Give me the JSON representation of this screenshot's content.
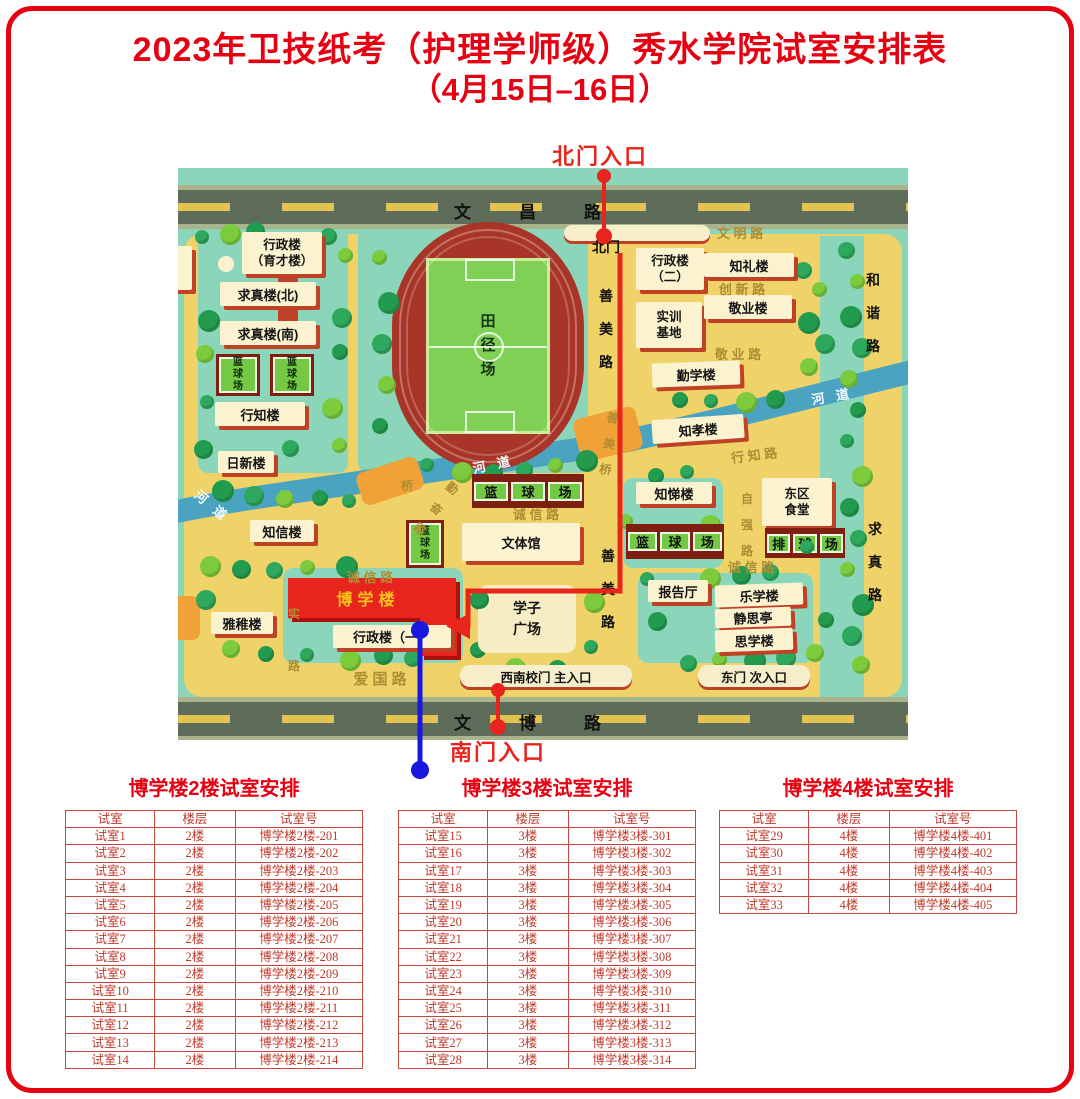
{
  "page": {
    "title_line1": "2023年卫技纸考（护理学师级）秀水学院试室安排表",
    "title_line2": "（4月15日–16日）"
  },
  "map": {
    "north_gate_entrance": "北门入口",
    "south_gate_entrance": "南门入口",
    "top_road": "文昌路",
    "bottom_road": "文博路",
    "track_label": "田\n径\n场",
    "items": [
      {
        "id": "bld-xingzhenglou-yucai",
        "cls": "b2",
        "label": "行政楼\n（育才楼）",
        "x": 64,
        "y": 64,
        "w": 80,
        "h": 42
      },
      {
        "id": "bld-qiuzhenlou-north",
        "cls": "b",
        "label": "求真楼(北)",
        "x": 42,
        "y": 114,
        "w": 96,
        "h": 24
      },
      {
        "id": "bld-qiuzhenlou-south",
        "cls": "b",
        "label": "求真楼(南)",
        "x": 42,
        "y": 153,
        "w": 96,
        "h": 24
      },
      {
        "id": "court-left-1",
        "cls": "courtv",
        "label": "篮\n球\n场",
        "x": 38,
        "y": 186,
        "w": 44,
        "h": 42
      },
      {
        "id": "court-left-2",
        "cls": "courtv",
        "label": "篮\n球\n场",
        "x": 92,
        "y": 186,
        "w": 44,
        "h": 42
      },
      {
        "id": "bld-xingzhilou",
        "cls": "b",
        "label": "行知楼",
        "x": 37,
        "y": 234,
        "w": 90,
        "h": 24
      },
      {
        "id": "bld-rixinlou",
        "cls": "b",
        "label": "日新楼",
        "x": 40,
        "y": 283,
        "w": 56,
        "h": 22
      },
      {
        "id": "bld-zhixinlou",
        "cls": "b",
        "label": "知信楼",
        "x": 72,
        "y": 352,
        "w": 64,
        "h": 22
      },
      {
        "id": "bld-yazhilou",
        "cls": "b",
        "label": "雅稚楼",
        "x": 33,
        "y": 444,
        "w": 62,
        "h": 22
      },
      {
        "id": "court-small",
        "cls": "courtv",
        "label": "篮\n球\n场",
        "x": 228,
        "y": 352,
        "w": 38,
        "h": 48
      },
      {
        "id": "bld-wentiguan",
        "cls": "b",
        "label": "文体馆",
        "x": 284,
        "y": 355,
        "w": 118,
        "h": 38
      },
      {
        "id": "plaza-xuezi",
        "cls": "plaza",
        "label": "学子\n广场",
        "x": 300,
        "y": 417,
        "w": 98,
        "h": 68
      },
      {
        "id": "courts-center",
        "cls": "courts3",
        "label": "篮球场",
        "x": 294,
        "y": 306,
        "w": 112,
        "h": 34
      },
      {
        "id": "bld-boxuelou-main",
        "cls": "red",
        "label": "",
        "x": 110,
        "y": 410,
        "w": 168,
        "h": 40
      },
      {
        "id": "bld-boxuelou-ext",
        "cls": "red",
        "label": "",
        "x": 242,
        "y": 450,
        "w": 37,
        "h": 38
      },
      {
        "id": "bld-boxuelou-label",
        "cls": "boxuelbl",
        "label": "博学楼",
        "x": 128,
        "y": 418,
        "w": 124,
        "h": 24
      },
      {
        "id": "bld-xingzhenglou-1",
        "cls": "b",
        "label": "行政楼（一）",
        "x": 155,
        "y": 457,
        "w": 118,
        "h": 23
      },
      {
        "id": "gate-north-strip",
        "cls": "strip",
        "label": "",
        "x": 386,
        "y": 57,
        "w": 146,
        "h": 16
      },
      {
        "id": "gate-north-label",
        "cls": "plain",
        "label": "北门",
        "x": 404,
        "y": 70,
        "w": 48,
        "h": 18
      },
      {
        "id": "bld-xingzhenglou-2",
        "cls": "b2",
        "label": "行政楼\n（二）",
        "x": 458,
        "y": 80,
        "w": 68,
        "h": 42
      },
      {
        "id": "bld-zhililou",
        "cls": "b",
        "label": "知礼楼",
        "x": 526,
        "y": 85,
        "w": 90,
        "h": 24
      },
      {
        "id": "bld-shixun-jidi",
        "cls": "b2",
        "label": "实训\n基地",
        "x": 458,
        "y": 134,
        "w": 66,
        "h": 46
      },
      {
        "id": "bld-jingyelou",
        "cls": "b",
        "label": "敬业楼",
        "x": 526,
        "y": 127,
        "w": 88,
        "h": 24
      },
      {
        "id": "bld-qinxuelou",
        "cls": "b",
        "label": "勤学楼",
        "x": 474,
        "y": 194,
        "w": 88,
        "h": 24,
        "rot": -2
      },
      {
        "id": "bld-zhixiaolou",
        "cls": "b",
        "label": "知孝楼",
        "x": 474,
        "y": 249,
        "w": 92,
        "h": 24,
        "rot": -4
      },
      {
        "id": "bld-zhitilou",
        "cls": "b",
        "label": "知悌楼",
        "x": 458,
        "y": 314,
        "w": 76,
        "h": 22
      },
      {
        "id": "bld-dongqu-shitang",
        "cls": "b2",
        "label": "东区\n食堂",
        "x": 584,
        "y": 310,
        "w": 70,
        "h": 48
      },
      {
        "id": "courts-right",
        "cls": "courts3",
        "label": "篮球场",
        "x": 448,
        "y": 356,
        "w": 98,
        "h": 35
      },
      {
        "id": "court-paiqiuchang",
        "cls": "courts3",
        "label": "排球场",
        "x": 587,
        "y": 360,
        "w": 80,
        "h": 30
      },
      {
        "id": "bld-baogaoting",
        "cls": "b",
        "label": "报告厅",
        "x": 470,
        "y": 412,
        "w": 60,
        "h": 22
      },
      {
        "id": "bld-lexuelou",
        "cls": "b",
        "label": "乐学楼",
        "x": 537,
        "y": 416,
        "w": 88,
        "h": 22,
        "rot": -2
      },
      {
        "id": "bld-jingsiting",
        "cls": "b",
        "label": "静思亭",
        "x": 537,
        "y": 440,
        "w": 76,
        "h": 19,
        "rot": -2
      },
      {
        "id": "bld-sixuelou",
        "cls": "b",
        "label": "思学楼",
        "x": 537,
        "y": 461,
        "w": 78,
        "h": 22,
        "rot": -2
      },
      {
        "id": "gate-southwest",
        "cls": "strip",
        "label": "西南校门  主入口",
        "x": 282,
        "y": 497,
        "w": 172,
        "h": 22
      },
      {
        "id": "gate-east",
        "cls": "strip",
        "label": "东门  次入口",
        "x": 520,
        "y": 497,
        "w": 112,
        "h": 22
      },
      {
        "id": "road-wenming",
        "cls": "lbl",
        "label": "文 明 路",
        "x": 516,
        "y": 56,
        "w": 92,
        "h": 16
      },
      {
        "id": "road-chuangxin",
        "cls": "lbl",
        "label": "创 新 路",
        "x": 518,
        "y": 112,
        "w": 92,
        "h": 16
      },
      {
        "id": "road-jingye",
        "cls": "lbl",
        "label": "敬 业 路",
        "x": 516,
        "y": 177,
        "w": 88,
        "h": 16
      },
      {
        "id": "road-xingzhi",
        "cls": "lbl",
        "label": "行 知 路",
        "x": 532,
        "y": 278,
        "w": 88,
        "h": 16,
        "rot": -7
      },
      {
        "id": "road-ziqiang",
        "cls": "vlbl",
        "label": "自\n强\n路",
        "x": 560,
        "y": 312,
        "w": 18,
        "h": 90
      },
      {
        "id": "road-chengxin-center",
        "cls": "lbl",
        "label": "诚 信 路",
        "x": 312,
        "y": 338,
        "w": 92,
        "h": 15
      },
      {
        "id": "road-chengxin-right",
        "cls": "lbl",
        "label": "诚 信 路",
        "x": 527,
        "y": 391,
        "w": 92,
        "h": 15
      },
      {
        "id": "road-chengxin-left",
        "cls": "lbl",
        "label": "诚 信 路",
        "x": 145,
        "y": 400,
        "w": 94,
        "h": 16
      },
      {
        "id": "road-qinfen",
        "cls": "vlbl",
        "label": "勤\n奋\n路",
        "x": 250,
        "y": 306,
        "w": 16,
        "h": 70,
        "rot": 38
      },
      {
        "id": "road-aiguo",
        "cls": "lbl",
        "label": "爱  国  路",
        "x": 140,
        "y": 500,
        "w": 124,
        "h": 20,
        "fs": 15
      },
      {
        "id": "road-shi",
        "cls": "vlbl",
        "label": "实\n\n路",
        "x": 108,
        "y": 442,
        "w": 16,
        "h": 60
      },
      {
        "id": "road-shanmei-upper",
        "cls": "vlblb",
        "label": "善\n美\n路",
        "x": 418,
        "y": 112,
        "w": 20,
        "h": 99
      },
      {
        "id": "road-shanmei-lower",
        "cls": "vlblb",
        "label": "善\n美\n路",
        "x": 420,
        "y": 372,
        "w": 20,
        "h": 99
      },
      {
        "id": "road-hexie",
        "cls": "vlblb",
        "label": "和\n谐\n路",
        "x": 684,
        "y": 96,
        "w": 22,
        "h": 99
      },
      {
        "id": "road-qiuzhen",
        "cls": "vlblb",
        "label": "求\n真\n路",
        "x": 686,
        "y": 345,
        "w": 22,
        "h": 99
      },
      {
        "id": "river-label-right",
        "cls": "wlbl",
        "label": "河 道",
        "x": 626,
        "y": 218,
        "w": 56,
        "h": 18,
        "rot": -10
      },
      {
        "id": "river-label-center",
        "cls": "wlbl",
        "label": "河 道",
        "x": 286,
        "y": 286,
        "w": 58,
        "h": 18,
        "rot": -12
      },
      {
        "id": "river-label-left",
        "cls": "wlbl",
        "label": "河 道",
        "x": 10,
        "y": 328,
        "w": 50,
        "h": 18,
        "rot": 40
      },
      {
        "id": "bridge-label",
        "cls": "vlbl",
        "label": "桥",
        "x": 222,
        "y": 310,
        "w": 14,
        "h": 16
      },
      {
        "id": "bridge-shanmei-label",
        "cls": "vlbl",
        "label": "善\n美\n桥",
        "x": 424,
        "y": 250,
        "w": 14,
        "h": 52,
        "rot": 8
      }
    ]
  },
  "tables": [
    {
      "title": "博学楼2楼试室安排",
      "headers": [
        "试室",
        "楼层",
        "试室号"
      ],
      "rows": [
        [
          "试室1",
          "2楼",
          "博学楼2楼-201"
        ],
        [
          "试室2",
          "2楼",
          "博学楼2楼-202"
        ],
        [
          "试室3",
          "2楼",
          "博学楼2楼-203"
        ],
        [
          "试室4",
          "2楼",
          "博学楼2楼-204"
        ],
        [
          "试室5",
          "2楼",
          "博学楼2楼-205"
        ],
        [
          "试室6",
          "2楼",
          "博学楼2楼-206"
        ],
        [
          "试室7",
          "2楼",
          "博学楼2楼-207"
        ],
        [
          "试室8",
          "2楼",
          "博学楼2楼-208"
        ],
        [
          "试室9",
          "2楼",
          "博学楼2楼-209"
        ],
        [
          "试室10",
          "2楼",
          "博学楼2楼-210"
        ],
        [
          "试室11",
          "2楼",
          "博学楼2楼-211"
        ],
        [
          "试室12",
          "2楼",
          "博学楼2楼-212"
        ],
        [
          "试室13",
          "2楼",
          "博学楼2楼-213"
        ],
        [
          "试室14",
          "2楼",
          "博学楼2楼-214"
        ]
      ]
    },
    {
      "title": "博学楼3楼试室安排",
      "headers": [
        "试室",
        "楼层",
        "试室号"
      ],
      "rows": [
        [
          "试室15",
          "3楼",
          "博学楼3楼-301"
        ],
        [
          "试室16",
          "3楼",
          "博学楼3楼-302"
        ],
        [
          "试室17",
          "3楼",
          "博学楼3楼-303"
        ],
        [
          "试室18",
          "3楼",
          "博学楼3楼-304"
        ],
        [
          "试室19",
          "3楼",
          "博学楼3楼-305"
        ],
        [
          "试室20",
          "3楼",
          "博学楼3楼-306"
        ],
        [
          "试室21",
          "3楼",
          "博学楼3楼-307"
        ],
        [
          "试室22",
          "3楼",
          "博学楼3楼-308"
        ],
        [
          "试室23",
          "3楼",
          "博学楼3楼-309"
        ],
        [
          "试室24",
          "3楼",
          "博学楼3楼-310"
        ],
        [
          "试室25",
          "3楼",
          "博学楼3楼-311"
        ],
        [
          "试室26",
          "3楼",
          "博学楼3楼-312"
        ],
        [
          "试室27",
          "3楼",
          "博学楼3楼-313"
        ],
        [
          "试室28",
          "3楼",
          "博学楼3楼-314"
        ]
      ]
    },
    {
      "title": "博学楼4楼试室安排",
      "headers": [
        "试室",
        "楼层",
        "试室号"
      ],
      "rows": [
        [
          "试室29",
          "4楼",
          "博学楼4楼-401"
        ],
        [
          "试室30",
          "4楼",
          "博学楼4楼-402"
        ],
        [
          "试室31",
          "4楼",
          "博学楼4楼-403"
        ],
        [
          "试室32",
          "4楼",
          "博学楼4楼-404"
        ],
        [
          "试室33",
          "4楼",
          "博学楼4楼-405"
        ]
      ]
    }
  ]
}
